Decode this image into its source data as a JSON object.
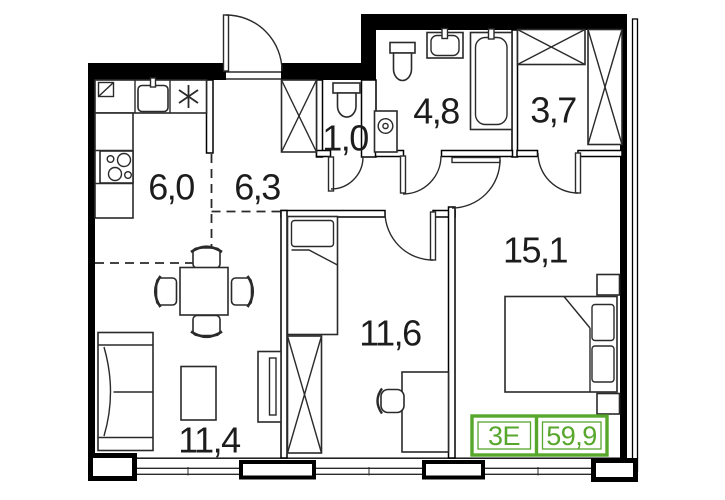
{
  "apartment": {
    "badge": {
      "plan_type": "3E",
      "total_area": "59,9",
      "accent_color": "#57a72d"
    },
    "rooms": [
      {
        "name": "kitchen",
        "area_label": "6,0"
      },
      {
        "name": "hallway",
        "area_label": "6,3"
      },
      {
        "name": "wc",
        "area_label": "1,0"
      },
      {
        "name": "bathroom",
        "area_label": "4,8"
      },
      {
        "name": "dressing-room",
        "area_label": "3,7"
      },
      {
        "name": "bedroom",
        "area_label": "15,1"
      },
      {
        "name": "bedroom-2",
        "area_label": "11,6"
      },
      {
        "name": "living-room",
        "area_label": "11,4"
      }
    ]
  }
}
